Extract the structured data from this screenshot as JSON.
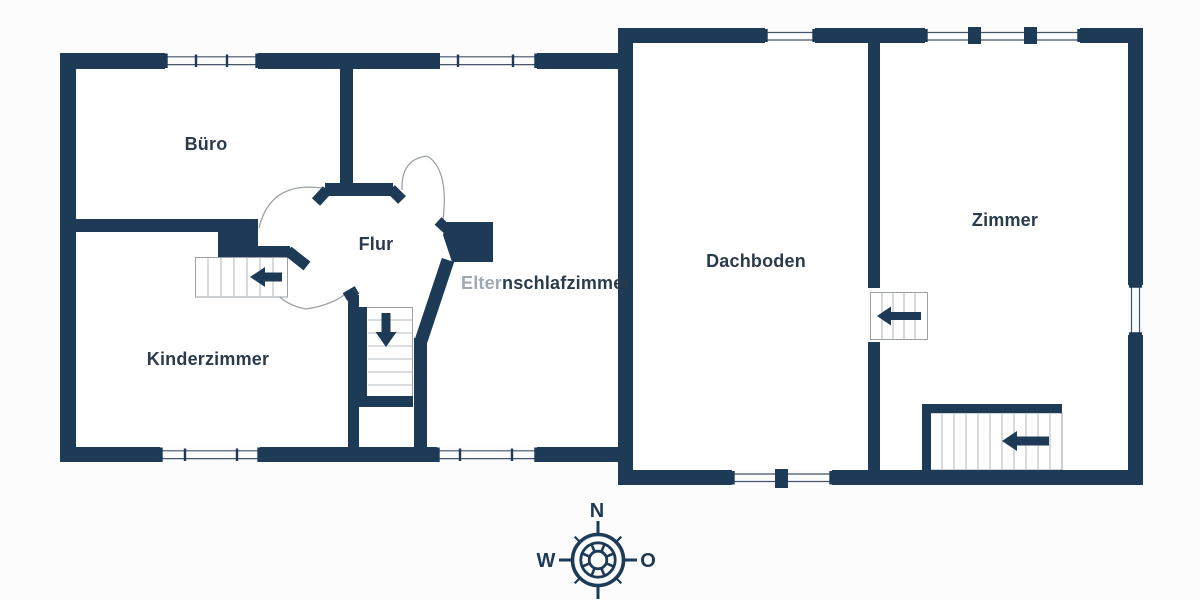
{
  "meta": {
    "type": "floor-plan",
    "floor": "attic-level"
  },
  "theme": {
    "bg": "#fcfcfc",
    "room": "#ffffff",
    "wall": "#1d3a57",
    "label": "#2a3b4d",
    "label-muted": "#9fa9b3",
    "arc": "#9ba1a7",
    "tread": "#b7bdc3",
    "win": "#44546a"
  },
  "rooms": {
    "buero": {
      "label": "Büro"
    },
    "kinderzimmer": {
      "label": "Kinderzimmer"
    },
    "flur": {
      "label": "Flur"
    },
    "elternschlafzimmer": {
      "label_start": "Elter",
      "label_end": "nschlafzimmer"
    },
    "dachboden": {
      "label": "Dachboden"
    },
    "zimmer": {
      "label": "Zimmer"
    }
  },
  "stairs": [
    {
      "id": "hall-stairs",
      "icon": "arrow-left-icon"
    },
    {
      "id": "flur-down-stairs",
      "icon": "arrow-down-icon"
    },
    {
      "id": "attic-connector-stairs",
      "icon": "arrow-left-icon"
    },
    {
      "id": "zimmer-stairs",
      "icon": "arrow-left-icon"
    }
  ],
  "compass": {
    "north": "N",
    "west": "W",
    "east": "O"
  }
}
